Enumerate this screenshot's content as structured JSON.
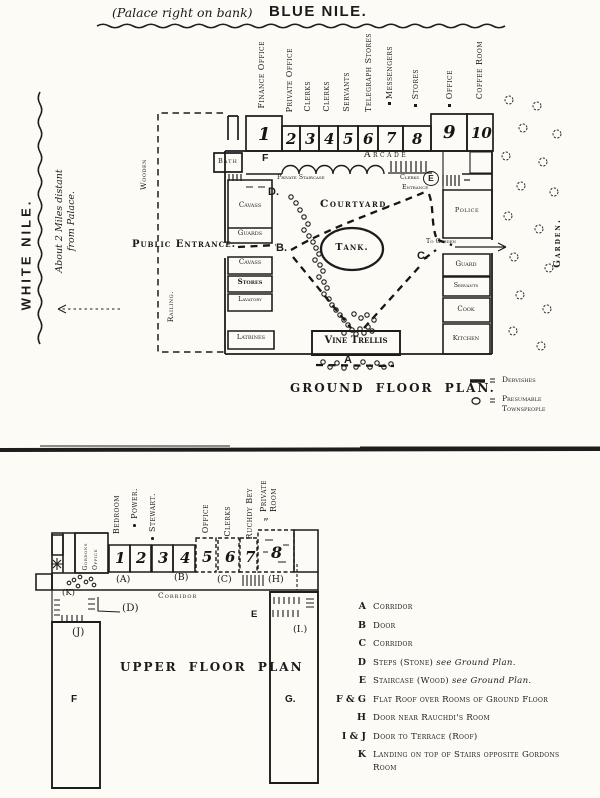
{
  "header": {
    "title_prefix": "(Palace right on bank)",
    "title_main": "BLUE NILE."
  },
  "west_bank": {
    "river": "WHITE NILE.",
    "note1": "About 2 Miles distant",
    "note2": "from Palace.",
    "fence_top": "Wooden",
    "fence_bottom": "Railing."
  },
  "ground_floor": {
    "caption": "GROUND FLOOR PLAN.",
    "top_rooms": [
      {
        "num": "1",
        "label": "Finance Office"
      },
      {
        "num": "2",
        "label": "Private Office"
      },
      {
        "num": "3",
        "label": "Clerks"
      },
      {
        "num": "4",
        "label": "Clerks"
      },
      {
        "num": "5",
        "label": "Servants"
      },
      {
        "num": "6",
        "label": "Telegraph Stores"
      },
      {
        "num": "7",
        "label": "Messengers"
      },
      {
        "num": "8",
        "label": "Stores"
      },
      {
        "num": "9",
        "label": "Office"
      },
      {
        "num": "10",
        "label": "Coffee Room"
      }
    ],
    "labels": {
      "bath": "Bath",
      "f": "F",
      "arcade": "Arcade",
      "private_staircase": "Private Staircase",
      "clerks_entrance_top": "Clerks",
      "clerks_entrance_bottom": "Entrance",
      "e": "E",
      "cavass_upper": "Cavass",
      "guards": "Guards",
      "public_entrance": "Public Entrance.",
      "cavass_lower": "Cavass",
      "stores": "Stores",
      "lavatory": "Lavatory",
      "latrines": "Latrines",
      "courtyard": "Courtyard.",
      "tank": "Tank.",
      "vine_trellis": "Vine Trellis",
      "police": "Police",
      "to_garden": "To Garden",
      "garden": "Garden.",
      "guard": "Guard",
      "servants": "Servants",
      "cook": "Cook",
      "kitchen": "Kitchen"
    },
    "markers": {
      "a": "A",
      "b": "B.",
      "c": "C.",
      "d": "D."
    },
    "legend": {
      "dervishes": "Dervishes",
      "presumable": "Presumable",
      "townspeople": "Townspeople"
    }
  },
  "upper_floor": {
    "caption": "UPPER FLOOR PLAN",
    "gordons_office": [
      "Gordons",
      "Office"
    ],
    "rooms": [
      {
        "num": "1",
        "label": "Bedroom"
      },
      {
        "num": "2",
        "label": "Power."
      },
      {
        "num": "3",
        "label": "Stewart."
      },
      {
        "num": "4",
        "label": ""
      },
      {
        "num": "5",
        "label": "Office"
      },
      {
        "num": "6",
        "label": "Clerks"
      },
      {
        "num": "7",
        "label": "Ruchdy Bey"
      },
      {
        "num": "8",
        "label": [
          "Private",
          "Room"
        ],
        "ditto": "”"
      }
    ],
    "corridor": "Corridor",
    "markers": {
      "a": "(A)",
      "b": "(B)",
      "c": "(C)",
      "h": "(H)",
      "k": "(K)",
      "d": "(D)",
      "j": "(J)",
      "i": "(I.)",
      "e": "E",
      "f": "F",
      "g": "G."
    },
    "legend": [
      {
        "key": "A",
        "text": "Corridor",
        "note": "",
        "text2": ""
      },
      {
        "key": "B",
        "text": "Door",
        "note": "",
        "text2": ""
      },
      {
        "key": "C",
        "text": "Corridor",
        "note": "",
        "text2": ""
      },
      {
        "key": "D",
        "text": "Steps (Stone)",
        "note": "see Ground Plan.",
        "text2": ""
      },
      {
        "key": "E",
        "text": "Staircase (Wood)",
        "note": "see Ground Plan.",
        "text2": ""
      },
      {
        "key": "F & G",
        "text": "Flat Roof over Rooms of Ground Floor",
        "note": "",
        "text2": ""
      },
      {
        "key": "H",
        "text": "Door near Rauchdi's Room",
        "note": "",
        "text2": ""
      },
      {
        "key": "I & J",
        "text": "Door to Terrace (Roof)",
        "note": "",
        "text2": ""
      },
      {
        "key": "K",
        "text": "Landing on top of Stairs opposite Gordons",
        "note": "",
        "text2": "Room"
      }
    ]
  }
}
